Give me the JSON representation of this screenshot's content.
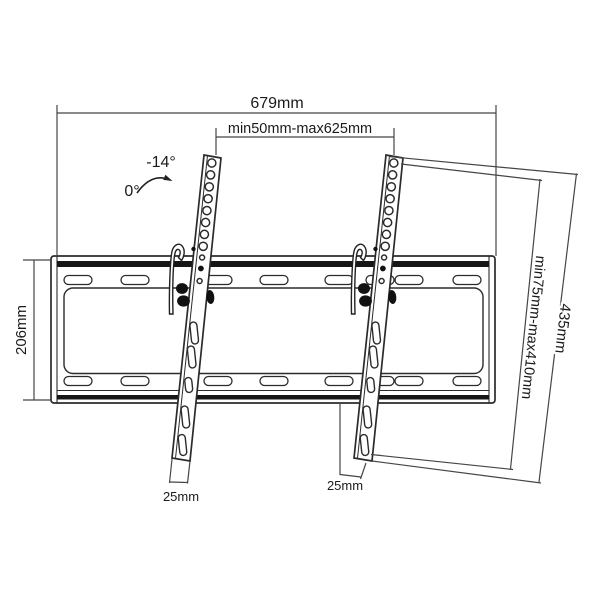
{
  "diagram": {
    "background": "#ffffff",
    "part_line_color": "#2b2b2b",
    "dimension_line_color": "#454545",
    "text_color": "#1a1a1a",
    "labels": {
      "total_width": "679mm",
      "rail_spacing": "min50mm-max625mm",
      "plate_height": "206mm",
      "rail_adjust_range": "min75mm-max410mm",
      "rail_length": "435mm",
      "left_rail_bottom_width": "25mm",
      "right_rail_bottom_width": "25mm",
      "tilt_angle_max": "-14°",
      "tilt_angle_min": "0°"
    }
  }
}
